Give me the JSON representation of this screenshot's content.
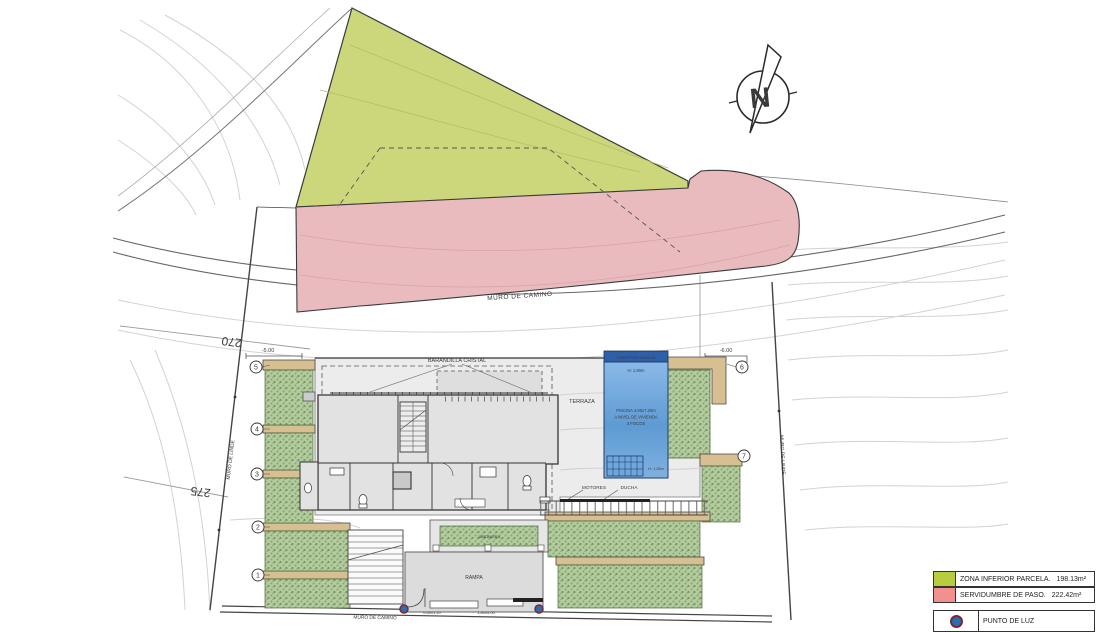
{
  "north": {
    "letter": "N"
  },
  "contour_labels": {
    "c270": "270",
    "c275": "275"
  },
  "walls": {
    "muro_camino_mid": "MURO DE CAMINO",
    "muro_camino_bottom": "MURO DE CAMINO",
    "muro_linde_left": "MURO DE LINDE",
    "muro_linde_right": "MURO DE LINDE"
  },
  "levels": {
    "left": "-5.00",
    "right": "-6.00"
  },
  "markers": {
    "m1": "1",
    "m2": "2",
    "m3": "3",
    "m4": "4",
    "m5": "5",
    "m6": "6",
    "m7": "7"
  },
  "house": {
    "barandilla": "BARANDILLA CRISTAL",
    "terraza": "TERRAZA",
    "motores": "MOTORES",
    "ducha": "DUCHA",
    "rampa": "RAMPA",
    "jardinera": "JARDINERA",
    "dim_door": "0.60x1.20",
    "dim_gate": "1.80x4.00"
  },
  "pool": {
    "cover": "COBERTOR 4.00x0.40",
    "depth_shallow": "H: 1.80m",
    "title": "PISCINA 4.00x7.20m",
    "line2": "A NIVEL DE VIVIENDA",
    "line3": "3 FOCOS",
    "depth_deep": "H: 1.20m"
  },
  "legend": {
    "zona_inferior": {
      "label": "ZONA INFERIOR PARCELA.",
      "area": "198.13m²"
    },
    "servidumbre": {
      "label": "SERVIDUMBRE DE PASO.",
      "area": "222.42m²"
    },
    "punto_luz": {
      "label": "PUNTO DE LUZ"
    }
  },
  "colors": {
    "zona_inferior": "#ccd67b",
    "servidumbre": "#e9bbbf",
    "pool_water": "#5b9bd5",
    "pool_cover": "#2e5fa9",
    "planter_green": "#afc898",
    "wall_tan": "#d8bf92",
    "legend_green": "#b8cc3f",
    "legend_red": "#f28f8f",
    "light_point_blue": "#2e6db4",
    "light_point_ring": "#7a2a2a"
  }
}
